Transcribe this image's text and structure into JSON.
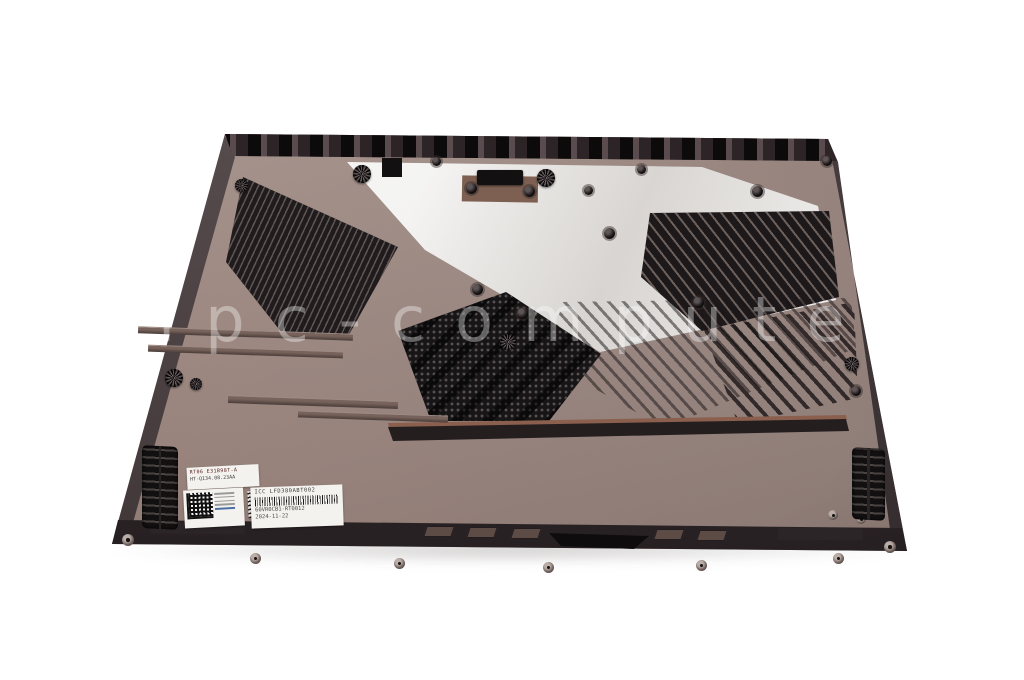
{
  "scene": {
    "subject": "laptop bottom case product photo",
    "background_color": "#ffffff"
  },
  "watermark": {
    "text": "ipc-computer"
  },
  "palette": {
    "case_base": "#97837c",
    "case_edge_dark": "#3a3133",
    "vent_black": "#1d191a",
    "plate_white": "#f2f1ef",
    "copper_accent": "#8a5f4e"
  },
  "stickers": {
    "mini_label": {
      "line1": "RT06 E31B98T-A",
      "line2": "HT-Q134.08.23AA"
    },
    "service_label": {
      "line1": "ICC  LFD380ABT002",
      "line2": "60VR0CB1-RT0012",
      "line3": "2024-11-22"
    }
  }
}
